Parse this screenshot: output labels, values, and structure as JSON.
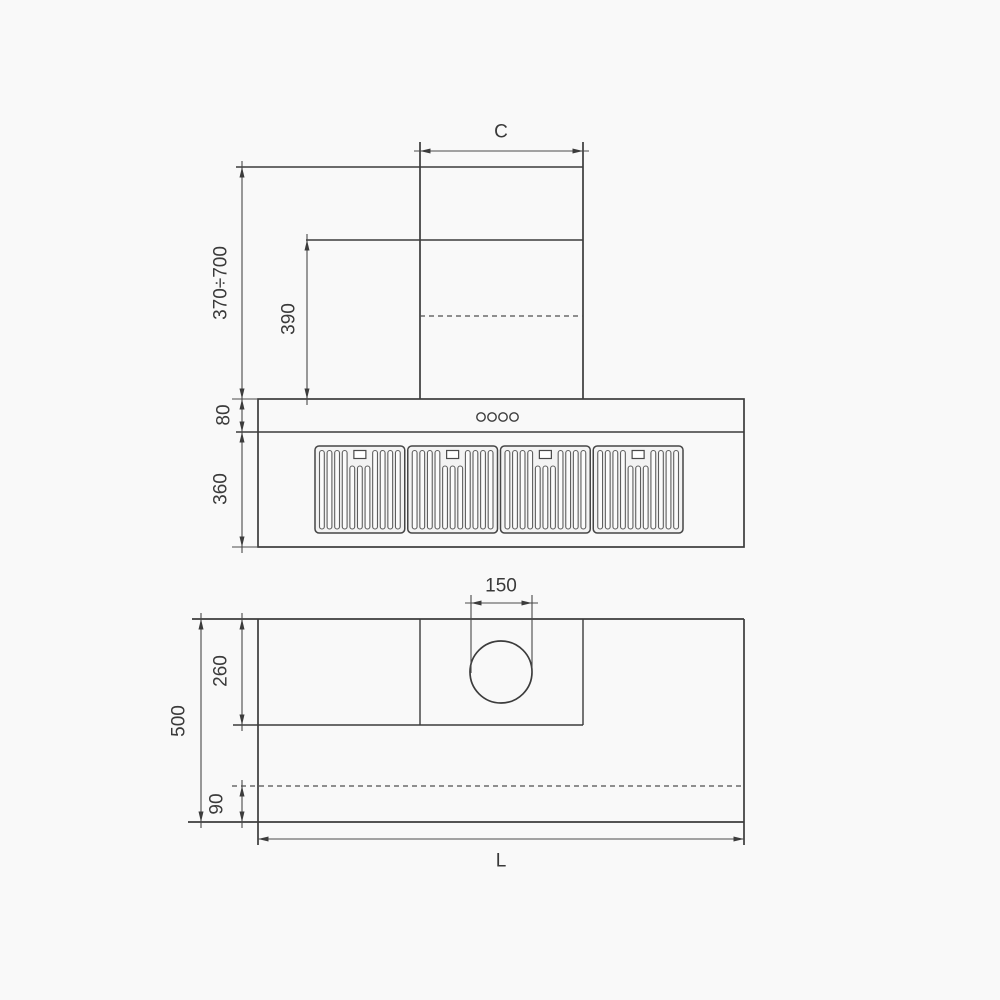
{
  "colors": {
    "background": "#f9f9f9",
    "line": "#3c3c3c",
    "text": "#3a3a3a"
  },
  "front_view": {
    "dims": {
      "chimney_width": "C",
      "hood_height_range": "370÷700",
      "chimney_lower_section": "390",
      "control_strip_height": "80",
      "filter_section_height": "360"
    },
    "control_buttons": {
      "count": 4
    },
    "filters": {
      "panel_count": 4,
      "slats_per_panel": 11,
      "short_slat_indices": [
        4,
        5,
        6
      ]
    }
  },
  "plan_view": {
    "dims": {
      "duct_hole_diameter": "150",
      "duct_box_depth": "260",
      "total_depth": "500",
      "front_edge_offset": "90",
      "total_width": "L"
    }
  }
}
